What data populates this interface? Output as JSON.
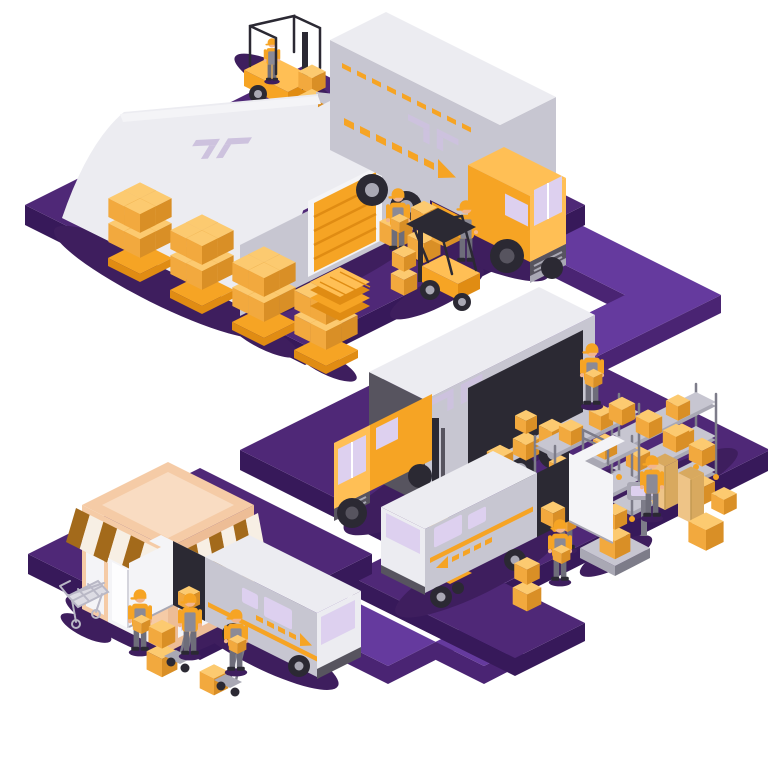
{
  "scene": {
    "title": "Isometric logistics and delivery process illustration",
    "background": "#ffffff",
    "stages": [
      {
        "id": "warehouse",
        "label": "Warehouse with arched roof, roller door, forklifts and pallet stacks"
      },
      {
        "id": "line-haul",
        "label": "Freight semi truck with branded trailer and direction arrow"
      },
      {
        "id": "distribution",
        "label": "Distribution center with storage racks, platform scale and workers unloading a truck"
      },
      {
        "id": "last-mile",
        "label": "Delivery van being loaded with parcels through open rear doors"
      },
      {
        "id": "retail",
        "label": "Retail store with striped awning, shopping cart and courier van delivery"
      }
    ],
    "route": {
      "label": "Purple isometric route connecting warehouse, distribution center and store"
    },
    "logo": {
      "name": "brackets-logo",
      "description": "Stylized double-bracket company mark on trailers and warehouse roof"
    }
  },
  "colors": {
    "platform": "#4f2877",
    "platformSide": "#37195a",
    "path": "#653a9e",
    "pathSide": "#4a2473",
    "shadow": "#3e1e5e",
    "orange": "#f6a424",
    "orangeLight": "#ffbf55",
    "orangeDark": "#e08c13",
    "boxTop": "#fcca70",
    "boxSide": "#f2a93e",
    "boxDark": "#d98f26",
    "carton": "#eec487",
    "cartonDark": "#d8a95f",
    "grayLight": "#ececf1",
    "gray": "#c7c6d1",
    "grayMid": "#a9a8b4",
    "grayDark": "#57545f",
    "lavender": "#ddd0ef",
    "logoTint": "#cdc2de",
    "peach": "#f5cba6",
    "peachLight": "#f9dcc2",
    "peachDark": "#edbd96",
    "awningBrown": "#a36a1b",
    "awningCream": "#f7efe4",
    "dark": "#2b2933",
    "steel": "#7d7c89",
    "skin": "#f2b58e",
    "pants": "#6e6d7a",
    "overall": "#8b8a96",
    "white": "#f4f4f7"
  }
}
